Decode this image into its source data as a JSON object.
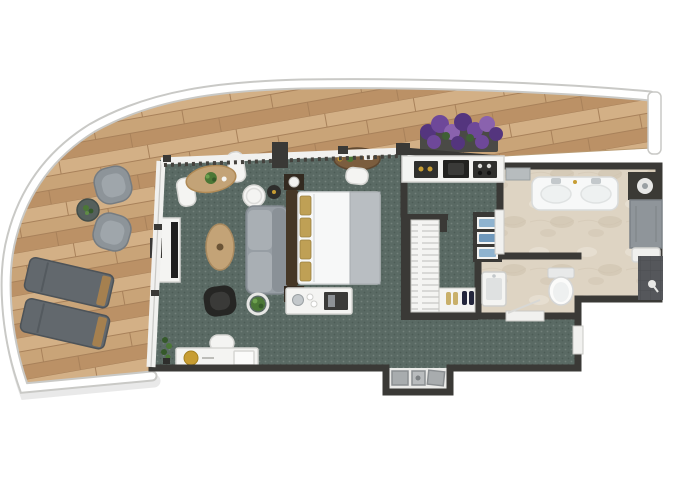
{
  "plan": {
    "kind": "apartment floor plan, top-down 3D render, no text labels",
    "areas": {
      "terrace": {
        "name": "curved wrap-around terrace",
        "floor": "wood planks",
        "items": [
          "lounge armchair",
          "lounge armchair",
          "round side table with plant",
          "sun lounger",
          "sun lounger",
          "lavender planter box"
        ]
      },
      "living_bedroom": {
        "name": "open living / bedroom",
        "floor": "teal patterned carpet",
        "items": [
          "dining table with two white chairs",
          "tv sideboard with tv",
          "round side table",
          "dark tray table",
          "gray sofa",
          "potted plant",
          "oval tan ottoman",
          "black armchair",
          "double bed with gold pillows and gray runner",
          "nightstand with lamp",
          "nightstand with lamp",
          "oval desk with white chair",
          "minibar console",
          "writing desk with gold tray and stool",
          "floor plant"
        ]
      },
      "kitchenette": {
        "name": "kitchenette",
        "items": [
          "counter with knobs, sink and cooktop"
        ]
      },
      "closet": {
        "name": "walk-in closet",
        "items": [
          "wardrobe with hanging clothes",
          "shoe shelf with two pairs",
          "towel shelf with blue towels"
        ]
      },
      "guest_wc": {
        "name": "guest wc",
        "floor": "marble",
        "items": [
          "washbasin",
          "toilet"
        ]
      },
      "bathroom": {
        "name": "main bathroom",
        "floor": "marble",
        "items": [
          "window sill",
          "double sink vanity",
          "shower column with rain head",
          "shower tray",
          "dark tiled wet wall"
        ]
      },
      "entry": {
        "name": "entry alcove",
        "items": [
          "doormat",
          "doormat",
          "doormat"
        ]
      }
    }
  },
  "colors": {
    "pageBg": "#ffffff",
    "railing": "#ffffff",
    "railingEdge": "#c9c9c6",
    "planShadow": "rgba(70,70,70,0.12)",
    "wood1": "#c9a478",
    "wood2": "#d3b086",
    "wood3": "#bb9166",
    "woodLine": "#a8815a",
    "carpetBase": "#5a6a64",
    "carpetDot": "#72817b",
    "carpetDark": "#4d5c56",
    "marbleBase": "#ded4c3",
    "marbleVein": "#cdc1ac",
    "marbleLight": "#e9e1d3",
    "wall": "#3a3936",
    "wallSoft": "#57554f",
    "glass": "#f1f1ef",
    "glassLine": "#c9c9c6",
    "whiteFurn": "#f4f4f2",
    "furnEdge": "#d6d6d3",
    "gray1": "#8d9499",
    "gray1Light": "#9fa6ab",
    "gray2": "#62686d",
    "sofaBase": "#979ea4",
    "sofaCushion": "#a9afb4",
    "black": "#262624",
    "woodFurn": "#7b5d3e",
    "woodFurnDark": "#5e4730",
    "tan": "#c3a377",
    "gold": "#c79d33",
    "bedWhite": "#f7f8f8",
    "bedGray": "#b9bec2",
    "headboard": "#453726",
    "pillowGold": "#bfa055",
    "plantGreen": "#4b7736",
    "plantDark": "#35592a",
    "purple1": "#6e4899",
    "purple2": "#54357e",
    "purple3": "#8a62ae",
    "towelBlue": "#8fb3cf",
    "towelBlue2": "#6f98bb",
    "tileGray": "#8f959a",
    "tileDark": "#55575b",
    "chrome": "#c3c8cb",
    "floorLight": "#ebebe9",
    "matGray": "#a8acae"
  }
}
